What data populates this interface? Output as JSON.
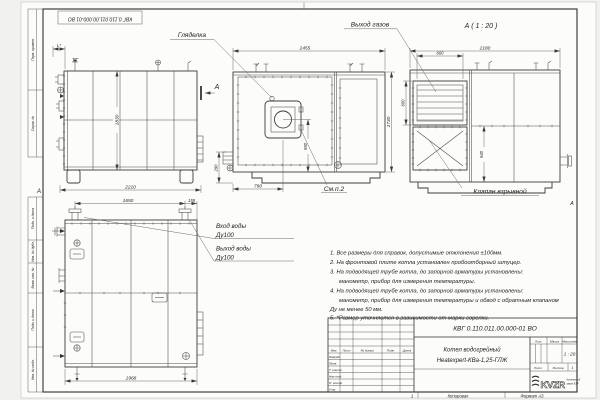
{
  "frame": {
    "stamp_vertical": "КВГ 0.110.011.00.000-01 ВО",
    "zone_left": "А",
    "zone_right": "А",
    "side_labels": [
      "Перв. примен.",
      "Справ. №",
      "Подп. и дата",
      "Инв. № дубл.",
      "Взам. инв. №",
      "Подп. и дата",
      "Инв. № подл."
    ]
  },
  "views": {
    "side": {
      "dim_height": "1830",
      "dim_width": "2210",
      "dim_left": "L*",
      "section_letter": "А"
    },
    "plan": {
      "label_sight": "Гляделка",
      "dim_width": "2455",
      "dim_depth": "1730",
      "dim_burner": "950",
      "dim_front": "790",
      "dim_side": "290",
      "note_ref": "См.п.2"
    },
    "section": {
      "title": "А ( 1 : 20 )",
      "label_gas": "Выход газов",
      "label_valve": "Клапан взрывной",
      "dim_width": "2180",
      "dim_louver_w": "660",
      "dim_louver_h": "600",
      "dim_valve": "940"
    },
    "rear": {
      "label_in1": "Вход воды",
      "label_in2": "Ду100",
      "label_out1": "Выход воды",
      "label_out2": "Ду100",
      "dim_pipes": "1650",
      "dim_edge": "159",
      "dim_width": "1968"
    }
  },
  "notes": [
    "1. Все размеры для справок, допустимые отклонения ±100мм.",
    "2. На фронтовой плите котла установлен пробоотборный штуцер.",
    "3. На подводящей трубе котла, до запорной арматуры установлены:",
    "манометр, прибор для измерения температуры.",
    "4. На подводящей трубе котла, до запорной арматуры установлены:",
    "манометр, прибор для измерения температуры и обвод с обратным клапаном",
    "Ду не менее 50 мм.",
    "5. *Размер уточняется в зависимости от марки горелки."
  ],
  "title_block": {
    "doc_number": "КВГ 0.110.011.00.000-01 ВО",
    "product_line1": "Котел водогрейный",
    "product_line2": "Heatexpert-КВа-1,25-ГЛЖ",
    "col_izm": "Изм.",
    "col_list": "Лист",
    "col_doc": "№ докум.",
    "col_sign": "Подп.",
    "col_date": "Дата",
    "rows": [
      "Разраб.",
      "Пров.",
      "Т. контр.",
      "Нач.отд.",
      "Н. контр.",
      "Утв."
    ],
    "lit": "Лит.",
    "mass": "Масса",
    "scale_label": "Масштаб",
    "scale": "1 : 20",
    "sheet": "Лист",
    "sheets": "Листов",
    "sheets_value": "1",
    "logo": "KVZR",
    "logo_cap1": "Котельный",
    "logo_cap2": "завод КЗР",
    "footer_zone": "1",
    "footer_copied": "Копировал",
    "footer_format": "Формат А3"
  }
}
